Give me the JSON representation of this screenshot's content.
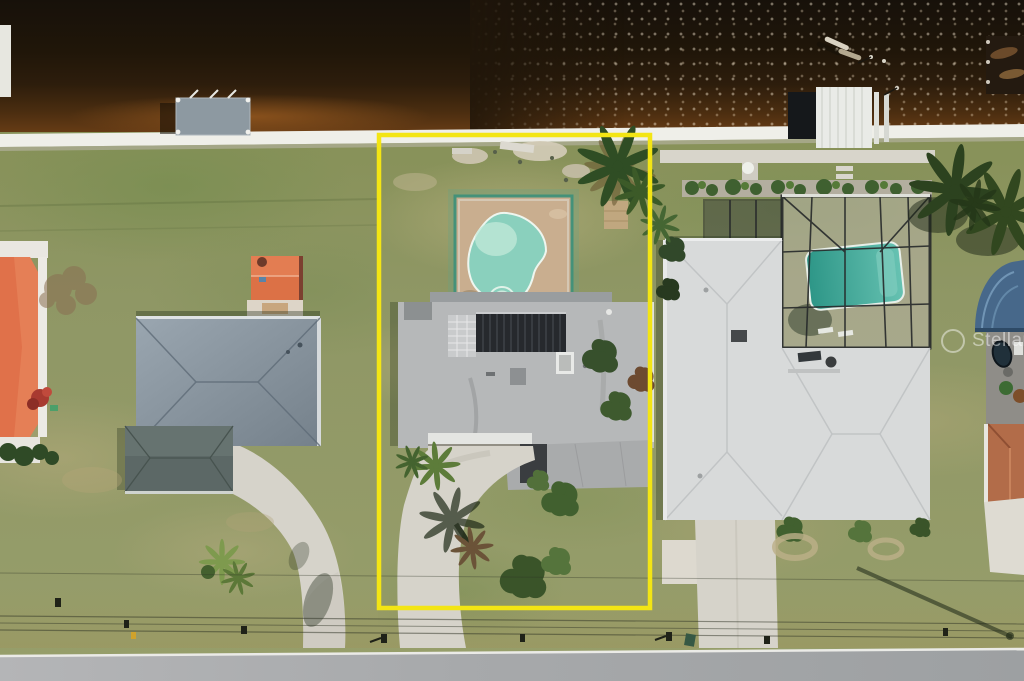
{
  "image": {
    "type": "aerial-drone-photo",
    "subject": "waterfront residential lots on a canal",
    "highlight": "center lot outlined in yellow property boundary"
  },
  "watermark": {
    "text": "Stellar MLS",
    "logo": "stellar-mls-circle-logo",
    "color": "#ffffff"
  },
  "boundary": {
    "color": "#f3e514"
  },
  "palette": {
    "water_dark": "#17110a",
    "water_amber": "#6b3e16",
    "seawall": "#efefe9",
    "grass_base": "#8b9363",
    "grass_tan": "#b5ab7e",
    "grass_dark": "#6d7b4b",
    "street": "#a7a9ab",
    "street_line": "#ebebe7",
    "pool_center": "#8ad0bd",
    "pool_shallow": "#c2ead9",
    "pool_deck": "#c9ae8f",
    "pool_frame_teal": "#3f9079",
    "roof_center": "#b6b8b9",
    "solar_panels": "#26292d",
    "roof_left": "#8794a0",
    "garage_left": "#5c6866",
    "roof_right": "#d8dada",
    "pool_cage": "#26292a",
    "pool_right": "#35a090",
    "roof_orange": "#df7049",
    "roof_blue": "#47688a",
    "roof_tile": "#b26c49",
    "driveway": "#d6d3ca",
    "dock_gray": "#8d99a1",
    "dock_white": "#e9ebe7",
    "palm_green": "#2e4a22"
  },
  "objects": [
    "canal",
    "seawall",
    "wood-dock",
    "boat-lift-dock",
    "kayaks",
    "far-right-dock",
    "center-lot-kidney-pool",
    "pool-deck",
    "center-house-gray-roof",
    "solar-panel-array",
    "curved-driveway",
    "yellow-property-boundary",
    "left-house-gray-roof",
    "garage-wing",
    "orange-shed",
    "orange-roof-house",
    "right-house-light-roof",
    "screened-pool-enclosure",
    "rectangular-pool",
    "palm-trees",
    "street",
    "power-lines",
    "mailboxes",
    "utility-pole-shadow"
  ]
}
